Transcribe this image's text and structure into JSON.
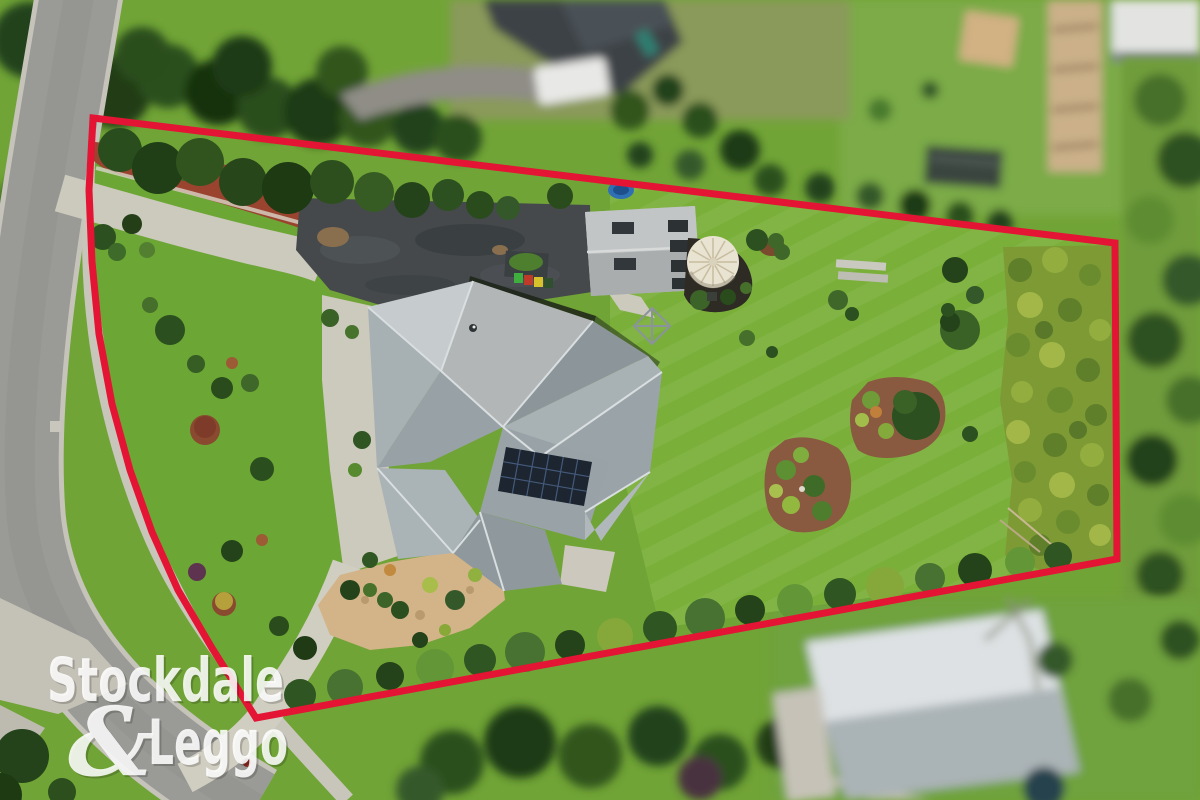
{
  "watermark": {
    "line1": "Stockdale",
    "amp": "&",
    "line2": "Leggo"
  },
  "colors": {
    "boundary_red": "#e41434",
    "watermark_white": "#ffffffde",
    "grass_green": "#71a437",
    "back_lawn_green": "#7ab03a",
    "road_gray": "#9a9a96",
    "gravel_dark": "#45494b",
    "roof_gray": "#b3b6b6",
    "solar_panel": "#1c2530",
    "tank_cream": "#e9e3d2",
    "mulch_red": "#9a4430",
    "mulch_tan": "#d3b488"
  }
}
